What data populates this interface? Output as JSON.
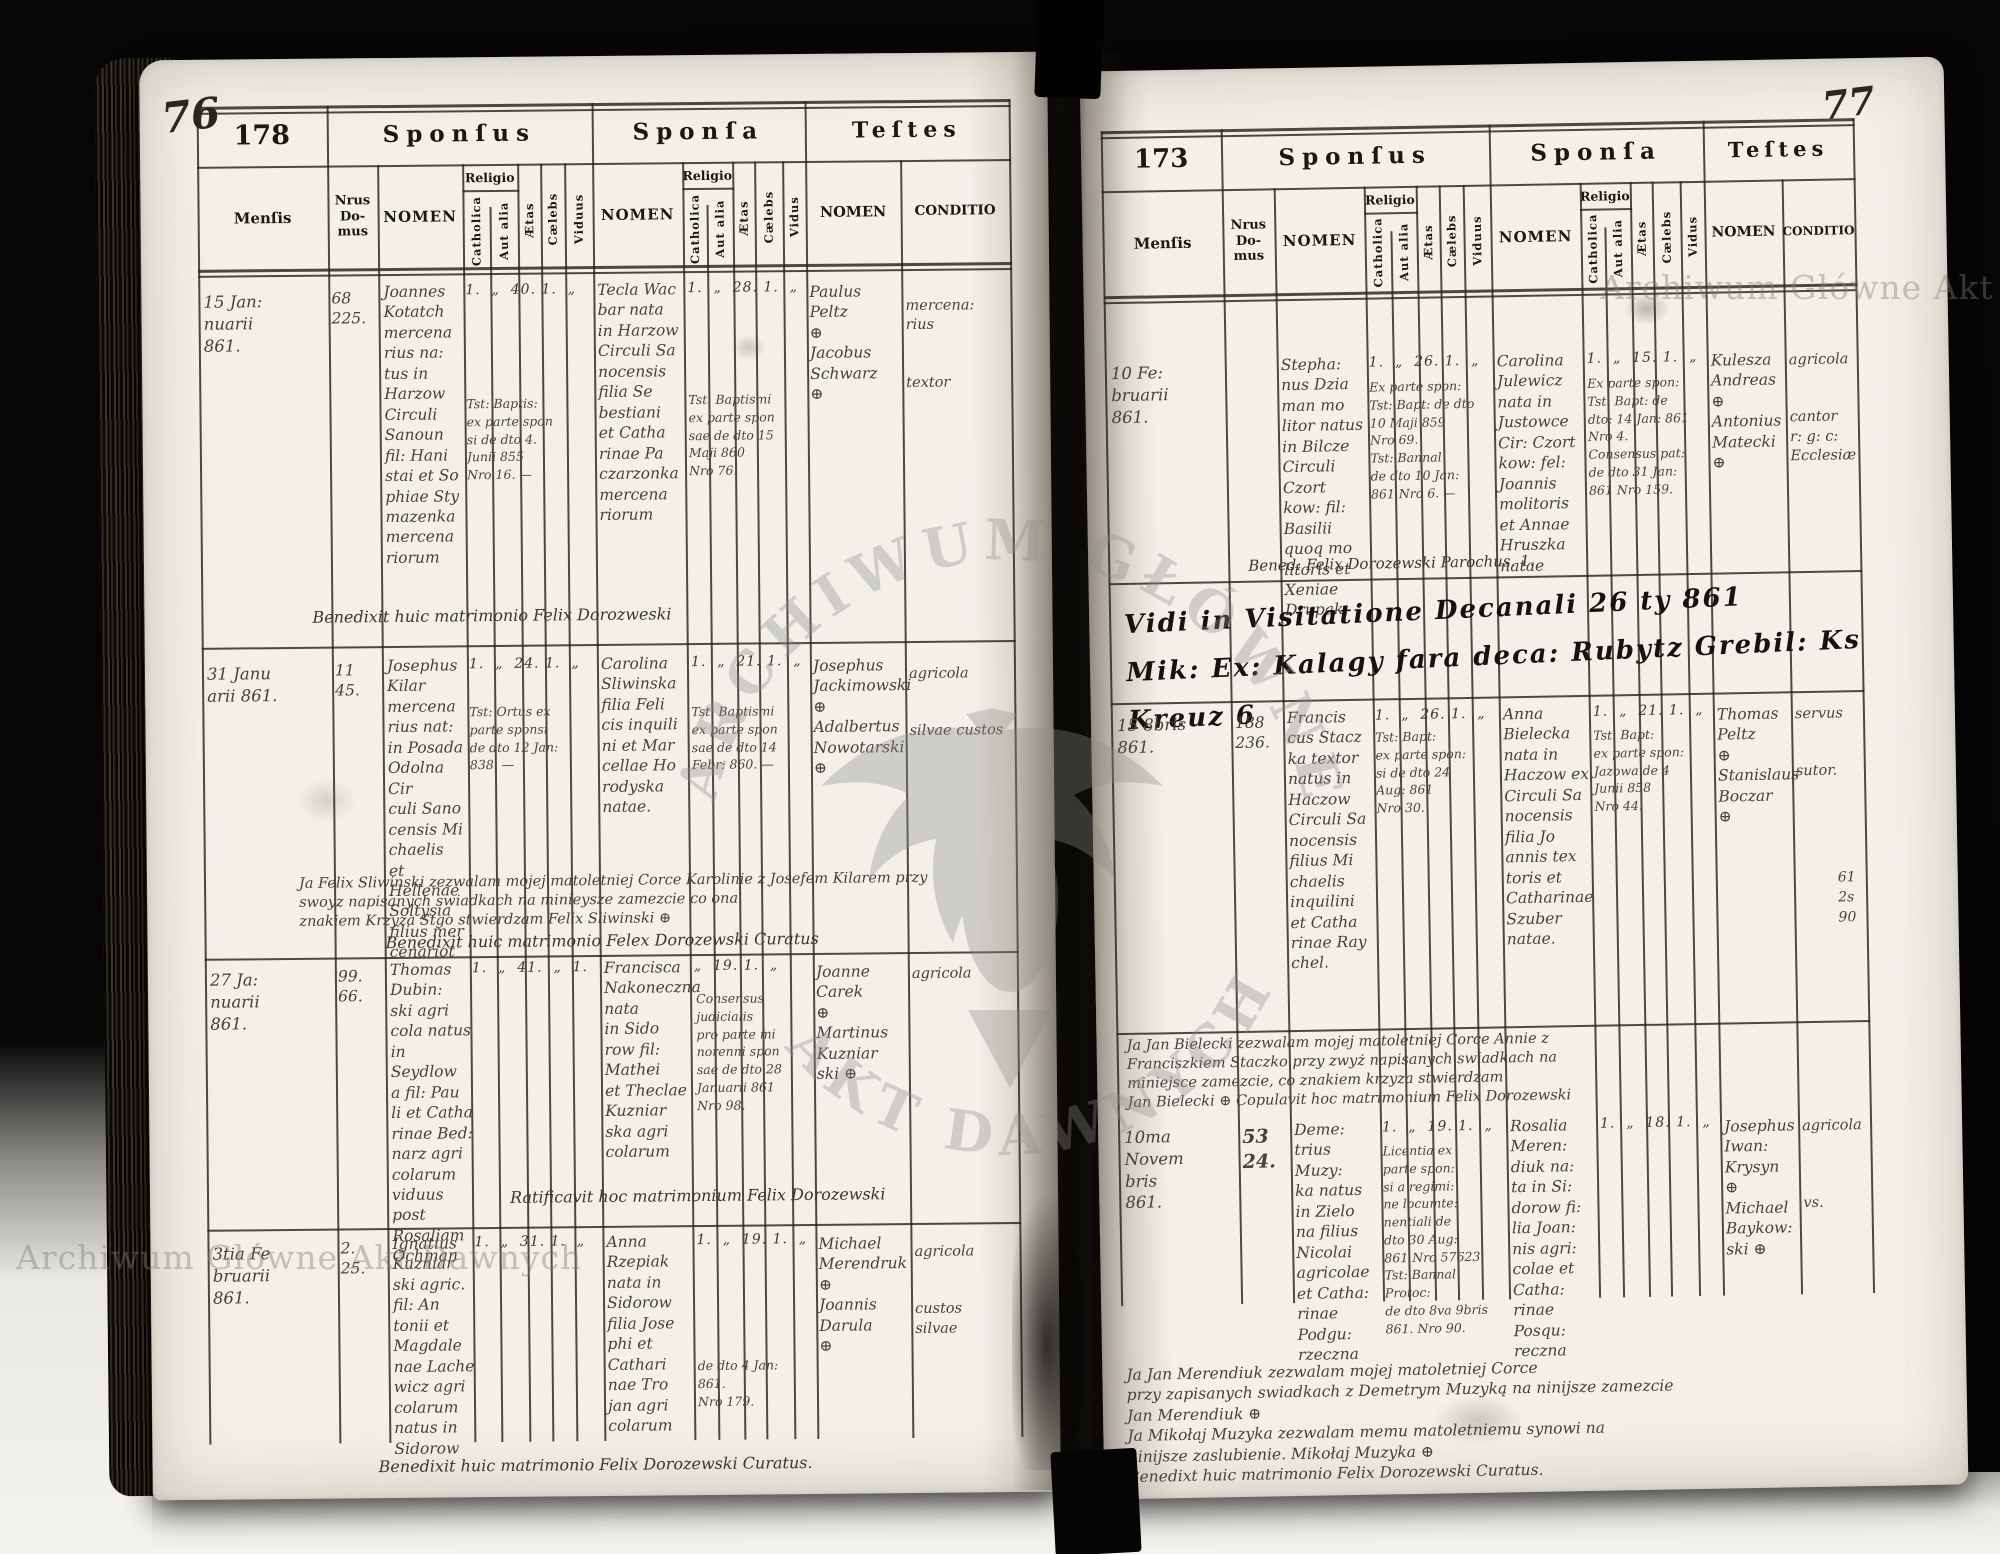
{
  "watermark": {
    "text": "Archiwum Główne Akt Dawnych",
    "seal_top": "ARCHIWUM GŁÓWNE",
    "seal_bottom": "AKT DAWNYCH"
  },
  "headers": {
    "sponsus": "Sponſus",
    "sponsa": "Sponſa",
    "testes": "Teſtes",
    "mensis": "Menſis",
    "nrus_domus": "Nrus\nDo-\nmus",
    "nomen": "NOMEN",
    "religio": "Religio",
    "catholica": "Catholica",
    "aut_alia": "Aut alia",
    "aetas": "Ætas",
    "caelebs": "Cælebs",
    "viduus": "Viduus",
    "vidus": "Vidus",
    "conditio": "CONDITIO"
  },
  "left_page": {
    "page_number": "76",
    "form_number": "178",
    "entries": [
      {
        "mensis": "15 Jan:\nnuarii\n861.",
        "domus": "68\n225.",
        "groom": "Joannes\nKotatch\nmercena\nrius na:\ntus in\nHarzow\nCirculi\nSanoun\nfil: Hani\nstai et So\nphiae Sty\nmazenka\nmercena\nriorum",
        "groom_flags": "1.  „  40. 1.  „",
        "groom_docs": "Tst: Baptis:\nex parte spon\nsi de dto 4.\nJunii 855\nNro 16. —",
        "bride": "Tecla Wac\nbar nata\nin Harzow\nCirculi Sa\nnocensis\nfilia Se\nbestiani\net Catha\nrinae Pa\nczarzonka\nmercena\nriorum",
        "bride_flags": "1.  „  28. 1.  „",
        "bride_docs": "Tst: Baptismi\nex parte spon\nsae de dto 15\nMaji 860\nNro 76.",
        "witnesses": "Paulus\nPeltz\n⊕\nJacobus\nSchwarz\n⊕",
        "conditio": "mercena:\nrius\n\n\ntextor",
        "note": "Benedixit huic matrimonio Felix Dorozweski"
      },
      {
        "mensis": "31 Janu\narii 861.",
        "domus": "11\n45.",
        "groom": "Josephus\nKilar\nmercena\nrius nat:\nin Posada\nOdolna Cir\nculi Sano\ncensis Mi\nchaelis\net Hellenae\nSoltysia\nfilius mer\ncenariot",
        "groom_flags": "1.  „  24. 1.  „",
        "groom_docs": "Tst: Ortus ex\nparte sponsi\nde dto 12 Jan:\n838. —",
        "bride": "Carolina\nSliwinska\nfilia Feli\ncis inquili\nni et Mar\ncellae Ho\nrodyska\nnatae.",
        "bride_flags": "1.  „  21. 1.  „",
        "bride_docs": "Tst: Baptismi\nex parte spon\nsae de dto 14\nFebr: 860. —",
        "witnesses": "Josephus\nJackimowski\n⊕\nAdalbertus\nNowotarski\n⊕",
        "conditio": "agricola\n\n\nsilvae custos",
        "note": "Ja Felix Sliwinski zezwalam mojej matoletniej Corce Karolinie z Josefem Kilarem przy\nswoyz napisanych swiadkach na minieysze zamezcie co ona\nznakiem Krzyza Stgo stwierdzam  Felix Sliwinski ⊕",
        "note2": "Benedixit huic matrimonio Felex Dorozewski Curatus"
      },
      {
        "mensis": "27 Ja:\nnuarii\n861.",
        "domus": "99.\n66.",
        "groom": "Thomas\nDubin:\nski agri\ncola natus\nin Seydlow\na fil: Pau\nli et Catha\nrinae Bed:\nnarz agri\ncolarum\nviduus post\nRosaliam\nOchman",
        "groom_flags": "1.  „  41.  „  1.",
        "bride": "Francisca\nNakoneczna\nnata\nin Sido\nrow fil:\nMathei\net Theclae\nKuzniar\nska agri\ncolarum",
        "bride_flags": "„  19. 1.  „",
        "bride_docs": "Consensus\njudicialis\npro parte mi\nnorenni spon\nsae de dto 28\nJanuarii 861\nNro 98.",
        "witnesses": "Joanne\nCarek\n⊕\nMartinus\nKuzniar\nski ⊕",
        "conditio": "agricola",
        "note": "Ratificavit hoc matrimonium Felix Dorozewski"
      },
      {
        "mensis": "3tia Fe\nbruarii\n861.",
        "domus": "2.\n25.",
        "groom": "Ignatius\nKuzniar\nski agric.\nfil: An\ntonii et\nMagdale\nnae Lache\nwicz agri\ncolarum\nnatus in\nSidorow",
        "groom_flags": "1.  „  31. 1.  „",
        "bride": "Anna\nRzepiak\nnata in\nSidorow\nfilia Jose\nphi et\nCathari\nnae Tro\njan agri\ncolarum",
        "bride_flags": "1.  „  19. 1.  „",
        "bride_docs": "de dto 4 Jan:\n861.\nNro 179.",
        "witnesses": "Michael\nMerendruk\n⊕\nJoannis\nDarula\n⊕",
        "conditio": "agricola\n\n\ncustos\nsilvae"
      }
    ],
    "footer": "Benedixit huic matrimonio Felix Dorozewski Curatus."
  },
  "right_page": {
    "page_number": "77",
    "form_number": "173",
    "entries": [
      {
        "mensis": "10 Fe:\nbruarii\n861.",
        "domus": "",
        "groom": "Stepha:\nnus Dzia\nman mo\nlitor natus\nin Bilcze\nCirculi Czort\nkow: fil:\nBasilii\nquoq mo\nlitoris et\nXeniae\nDrupak.",
        "groom_flags": "1.  „  26. 1.  „",
        "groom_docs": "Ex parte spon:\nTst: Bapt: de dto\n10 Maji 859\nNro 69.\nTst: Bannal\nde dto 10 Jan:\n861 Nro 6. —",
        "bride": "Carolina\nJulewicz\nnata in\nJustowce\nCir: Czort\nkow: fel:\nJoannis\nmolitoris\net Annae\nHruszka\nnatae",
        "bride_flags": "1.  „  15. 1.  „",
        "bride_docs": "Ex parte spon:\nTst: Bapt: de\ndto: 14 Jan: 861\nNro 4.\nConsensus pat:\nde dto 31 Jan:\n861 Nro 159.",
        "witnesses": "Kulesza\nAndreas\n⊕\nAntonius\nMatecki\n⊕",
        "conditio": "agricola\n\n\ncantor\nr: g: c:\nEcclesiæ",
        "note": "Bened:  Felix Dorozewski Parochus.    1."
      },
      {
        "mensis": "15 8bris\n861.",
        "domus": "188\n236.",
        "groom": "Francis\ncus Stacz\nka textor\nnatus in\nHaczow\nCirculi Sa\nnocensis\nfilius Mi\nchaelis\ninquilini\net Catha\nrinae Ray\nchel.",
        "groom_flags": "1.  „  26. 1.  „",
        "groom_docs": "Tst: Bapt:\nex parte spon:\nsi de dto 24\nAug: 861\nNro 30.",
        "bride": "Anna\nBielecka\nnata in\nHaczow ex\nCirculi Sa\nnocensis\nfilia Jo\nannis tex\ntoris et\nCatharinae\nSzuber\nnatae.",
        "bride_flags": "1.  „  21. 1.  „",
        "bride_docs": "Tst: Bapt:\nex parte spon:\nJazowa de 4\nJunii 858\nNro 44.",
        "margin": "61\n2s\n90",
        "witnesses": "Thomas\nPeltz\n⊕\nStanislaus\nBoczar\n⊕",
        "conditio": "servus\n\n\nsutor.",
        "note": "Ja Jan Bielecki zezwalam mojej matoletniej Corce Annie z\nFranciszkiem Staczko przy zwyż napisanych swiadkach na\nminiejsce zamezcie, co znakiem krzyza stwierdzam\nJan Bielecki ⊕  Copulavit hoc matrimonium Felix Dorozewski"
      },
      {
        "mensis": "10ma\nNovem\nbris\n861.",
        "domus": "53\n24.",
        "groom": "Deme:\ntrius\nMuzy:\nka natus\nin Zielo\nna filius\nNicolai\nagricolae\net Catha:\nrinae\nPodgu:\nrzeczna",
        "groom_flags": "1.  „  19. 1.  „",
        "groom_docs": "Licentia ex\nparte spon:\nsi a regimi:\nne locumte:\nnentiali de\ndto 30 Aug:\n861 Nro 57623\nTst: Bannal\nProtoc:\nde dto 8va 9bris\n861. Nro 90.",
        "bride": "Rosalia\nMeren:\ndiuk na:\nta in Si:\ndorow fi:\nlia Joan:\nnis agri:\ncolae et\nCatha:\nrinae\nPosqu:\nreczna",
        "bride_flags": "1.  „  18. 1.  „",
        "witnesses": "Josephus\nIwan:\nKrysyn\n⊕\nMichael\nBaykow:\nski ⊕",
        "conditio": "agricola\n\n\n\nvs."
      }
    ],
    "visitation": "Vidi in Visitatione Decanali 26 ty 861\nMik: Ex: Kalagy fara deca: Rubytz Grebil: Ks Kreuz  6",
    "notes": "Ja Jan Merendiuk zezwalam mojej matoletniej Corce\nprzy zapisanych swiadkach z Demetrym Muzyką na ninijsze zamezcie\nJan Merendiuk ⊕\nJa Mikołaj Muzyka zezwalam memu matoletniemu synowi na\nninijsze zaslubienie. Mikołaj Muzyka ⊕\nBenedixt huic matrimonio Felix Dorozewski Curatus."
  }
}
